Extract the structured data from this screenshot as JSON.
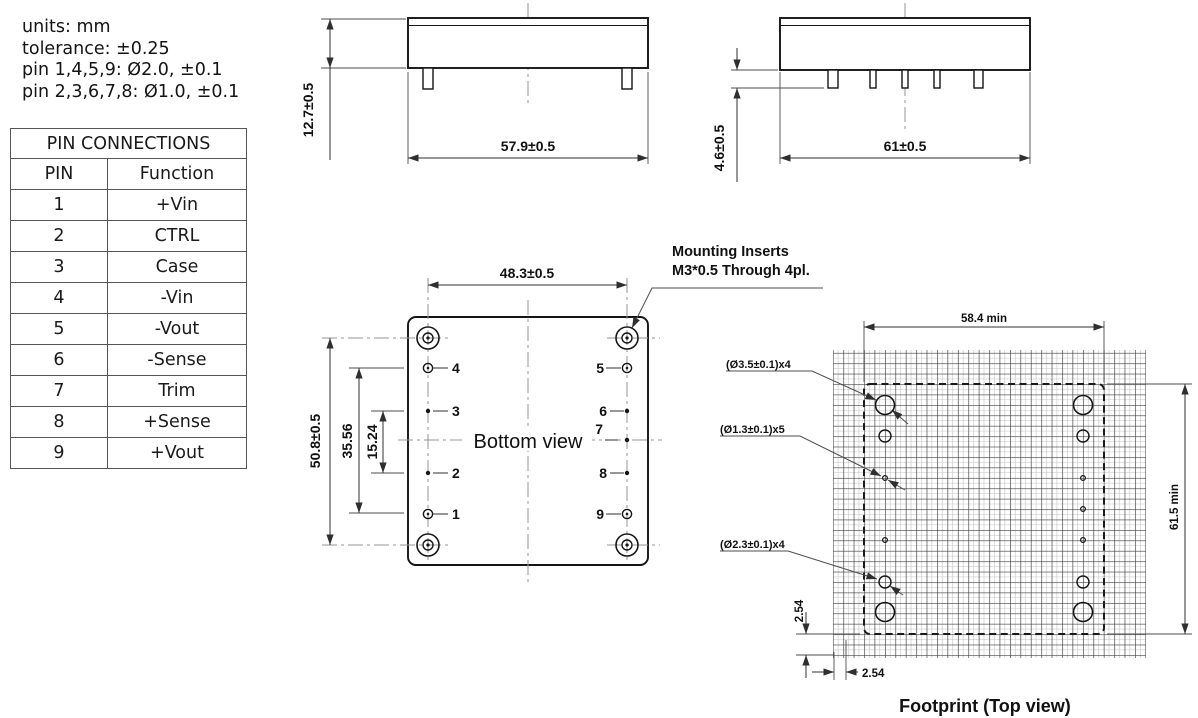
{
  "colors": {
    "background": "#ffffff",
    "ink": "#141414",
    "dim_lines": "#2f2f2f",
    "centerline": "#949494",
    "grid_dark": "#3d3d3d",
    "grid_light": "#c3c3c3"
  },
  "notes": {
    "lines": [
      "units: mm",
      "tolerance: ±0.25",
      "pin 1,4,5,9: Ø2.0, ±0.1",
      "pin 2,3,6,7,8: Ø1.0, ±0.1"
    ]
  },
  "pin_table": {
    "title": "PIN CONNECTIONS",
    "col_pin": "PIN",
    "col_function": "Function",
    "rows": [
      {
        "pin": "1",
        "fn": "+Vin"
      },
      {
        "pin": "2",
        "fn": "CTRL"
      },
      {
        "pin": "3",
        "fn": "Case"
      },
      {
        "pin": "4",
        "fn": "-Vin"
      },
      {
        "pin": "5",
        "fn": "-Vout"
      },
      {
        "pin": "6",
        "fn": "-Sense"
      },
      {
        "pin": "7",
        "fn": "Trim"
      },
      {
        "pin": "8",
        "fn": "+Sense"
      },
      {
        "pin": "9",
        "fn": "+Vout"
      }
    ]
  },
  "front_view": {
    "height_dim": "12.7±0.5",
    "width_dim": "57.9±0.5"
  },
  "side_view": {
    "pin_length_dim": "4.6±0.5",
    "width_dim": "61±0.5"
  },
  "bottom_view": {
    "label": "Bottom view",
    "width_dim": "48.3±0.5",
    "height_dim": "50.8±0.5",
    "outer_pin_span_dim": "35.56",
    "inner_pin_span_dim": "15.24",
    "left_pins": [
      "4",
      "3",
      "2",
      "1"
    ],
    "right_pins": [
      "5",
      "6",
      "7",
      "8",
      "9"
    ],
    "mounting_note_line1": "Mounting Inserts",
    "mounting_note_line2": "M3*0.5 Through 4pl."
  },
  "footprint": {
    "label": "Footprint (Top view)",
    "width_dim": "58.4 min",
    "height_dim": "61.5 min",
    "row_pitch_dim": "2.54",
    "col_pitch_dim": "2.54",
    "callouts": {
      "mounting": "(Ø3.5±0.1)x4",
      "small": "(Ø1.3±0.1)x5",
      "large": "(Ø2.3±0.1)x4"
    }
  }
}
